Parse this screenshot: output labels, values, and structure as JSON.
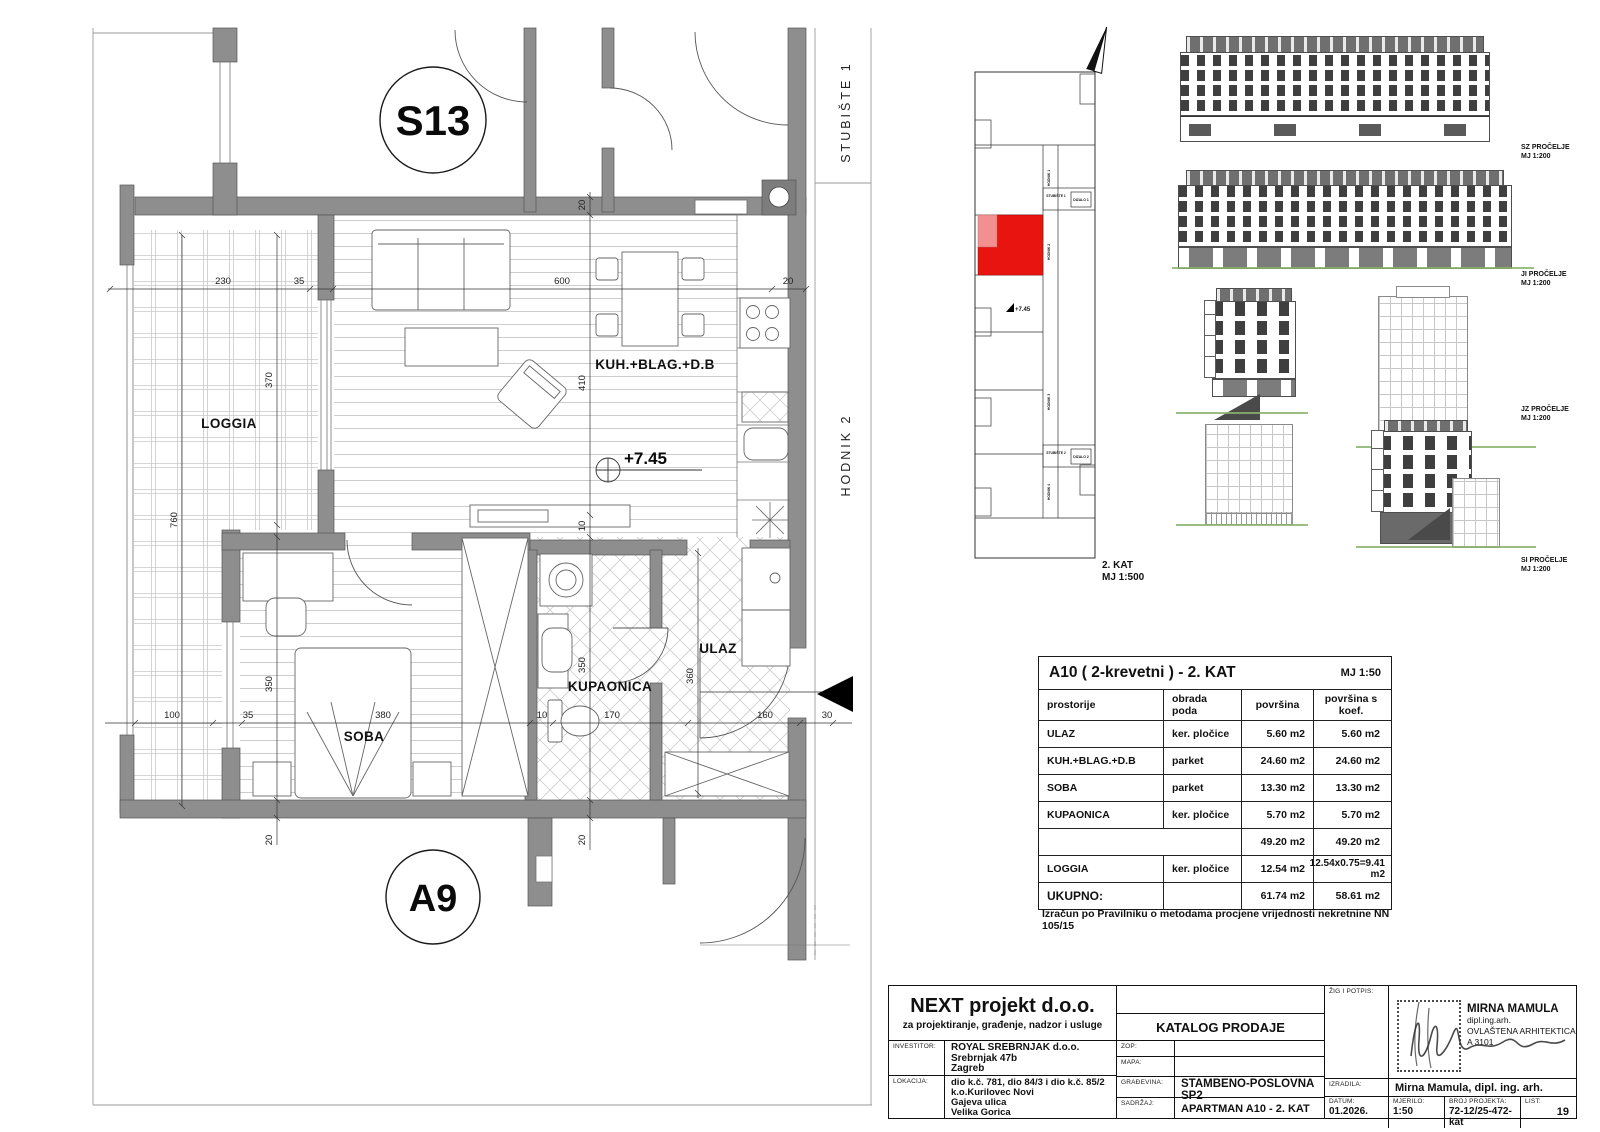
{
  "colors": {
    "highlight_red": "#e81410",
    "highlight_red_light": "#f29090",
    "wall_gray": "#8e8e8e",
    "ground_green": "#8ab36d"
  },
  "plan": {
    "labels": {
      "s13": "S13",
      "a9": "A9",
      "loggia": "LOGGIA",
      "kuh": "KUH.+BLAG.+D.B",
      "soba": "SOBA",
      "kupaonica": "KUPAONICA",
      "ulaz": "ULAZ",
      "level": "+7.45",
      "stubiste": "STUBIŠTE 1",
      "hodnik": "HODNIK 2"
    },
    "dims": {
      "top_230": "230",
      "top_35": "35",
      "top_600": "600",
      "top_20": "20",
      "wall_20": "20",
      "left_370": "370",
      "left_760": "760",
      "mid_410": "410",
      "mid_10": "10",
      "left_350": "350",
      "kupa_350": "350",
      "ulaz_360": "360",
      "bot_100": "100",
      "bot_35": "35",
      "bot_380": "380",
      "bot_10": "10",
      "bot_170": "170",
      "bot_160": "160",
      "bot_30": "30",
      "bot_20a": "20",
      "bot_20b": "20"
    }
  },
  "keyplan": {
    "hodnik1": "HODNIK 1",
    "hodnik2": "HODNIK 2",
    "hodnik3": "HODNIK 3",
    "hodnik4": "HODNIK 4",
    "stubiste1": "STUBIŠTE 1",
    "dizalo1": "DIZALO 1",
    "stubiste2": "STUBIŠTE 2",
    "dizalo2": "DIZALO 2",
    "level": "+7.45",
    "caption1": "2. KAT",
    "caption2": "MJ 1:500"
  },
  "elevations": [
    {
      "name": "SZ PROČELJE",
      "scale": "MJ 1:200"
    },
    {
      "name": "JI PROČELJE",
      "scale": "MJ 1:200"
    },
    {
      "name": "JZ PROČELJE",
      "scale": "MJ 1:200"
    },
    {
      "name": "SI PROČELJE",
      "scale": "MJ 1:200"
    }
  ],
  "area_table": {
    "title": "A10 ( 2-krevetni ) - 2. KAT",
    "scale": "MJ 1:50",
    "headers": [
      "prostorije",
      "obrada poda",
      "površina",
      "površina s koef."
    ],
    "rows": [
      [
        "ULAZ",
        "ker. pločice",
        "5.60 m2",
        "5.60 m2"
      ],
      [
        "KUH.+BLAG.+D.B",
        "parket",
        "24.60 m2",
        "24.60 m2"
      ],
      [
        "SOBA",
        "parket",
        "13.30 m2",
        "13.30 m2"
      ],
      [
        "KUPAONICA",
        "ker. pločice",
        "5.70 m2",
        "5.70 m2"
      ],
      [
        "",
        "",
        "49.20 m2",
        "49.20 m2"
      ],
      [
        "LOGGIA",
        "ker. pločice",
        "12.54 m2",
        "12.54x0.75=9.41 m2"
      ],
      [
        "UKUPNO:",
        "",
        "61.74 m2",
        "58.61 m2"
      ]
    ],
    "note": "Izračun po Pravilniku o metodama procjene vrijednosti nekretnine  NN 105/15"
  },
  "titleblock": {
    "company": "NEXT projekt d.o.o.",
    "company_sub": "za projektiranje, građenje, nadzor i usluge",
    "investitor_label": "INVESTITOR:",
    "investitor1": "ROYAL SREBRNJAK d.o.o.",
    "investitor2": "Srebrnjak 47b",
    "investitor3": "Zagreb",
    "lokacija_label": "LOKACIJA:",
    "lokacija1": "dio k.č. 781, dio 84/3 i dio k.č. 85/2",
    "lokacija2": "k.o.Kurilovec Novi",
    "lokacija3": "Gajeva ulica",
    "lokacija4": "Velika Gorica",
    "katalog": "KATALOG PRODAJE",
    "zop_label": "ZOP:",
    "mapa_label": "MAPA:",
    "gradjevina_label": "GRAĐEVINA:",
    "gradjevina": "STAMBENO-POSLOVNA SP2",
    "sadrzaj_label": "SADRŽAJ:",
    "sadrzaj": "APARTMAN A10 - 2. KAT",
    "zig_label": "ŽIG I POTPIS:",
    "architect_name": "MIRNA MAMULA",
    "architect_title": "dipl.ing.arh.",
    "architect_role": "OVLAŠTENA ARHITEKTICA",
    "architect_id": "A 3101",
    "izradila_label": "IZRADILA:",
    "izradila": "Mirna Mamula, dipl. ing. arh.",
    "datum_label": "DATUM:",
    "datum": "01.2026.",
    "mjerilo_label": "MJERILO:",
    "mjerilo": "1:50",
    "broj_label": "BROJ PROJEKTA:",
    "broj": "72-12/25-472-kat",
    "list_label": "LIST:",
    "list": "19"
  }
}
